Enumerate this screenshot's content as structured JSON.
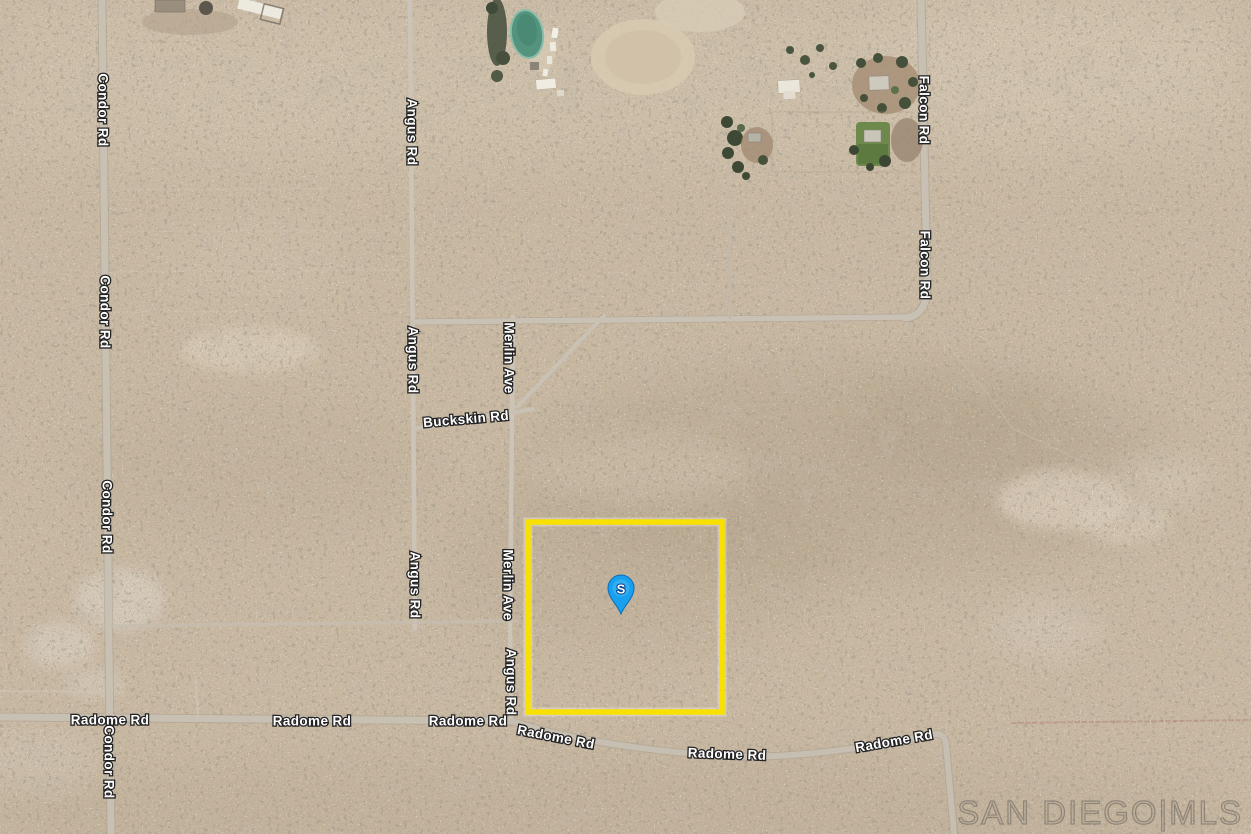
{
  "map": {
    "roads": {
      "condor": "Condor Rd",
      "angus": "Angus Rd",
      "merlin": "Merlin Ave",
      "falcon": "Falcon Rd",
      "buckskin": "Buckskin Rd",
      "radome": "Radome Rd"
    },
    "marker": {
      "label": "S",
      "pin_color": "#18a0ee"
    },
    "parcel": {
      "outline_color": "#f8e000"
    },
    "watermark": {
      "text": "SAN DIEGO|MLS"
    },
    "terrain_colors": {
      "base": "#c9b9a3",
      "speckle": "#6e6051",
      "road": "#ccc4b6",
      "pool": "#54937e",
      "lawn": "#6d8a4c"
    }
  }
}
